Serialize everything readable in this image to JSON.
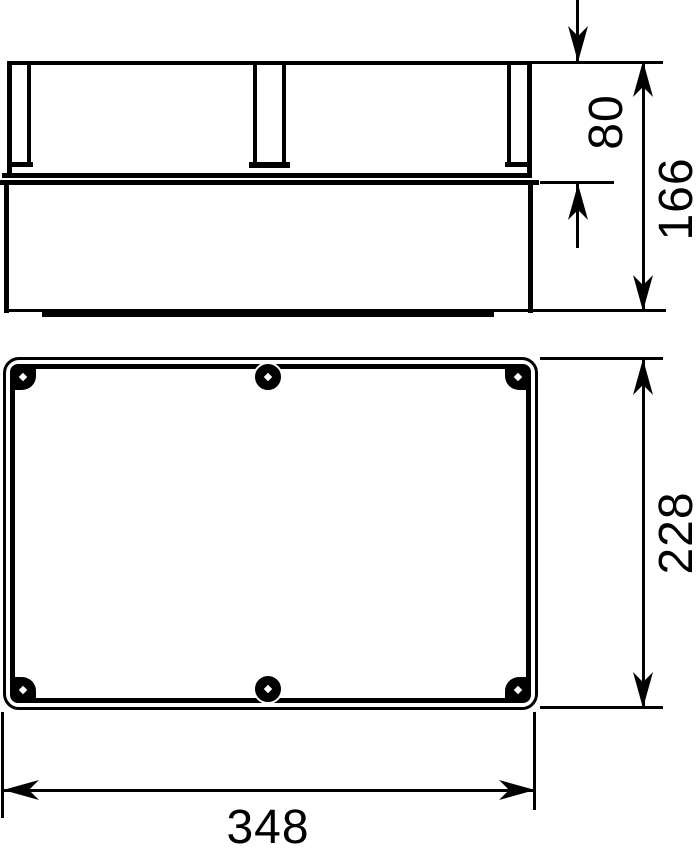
{
  "title": "Enclosure dimension drawing",
  "colors": {
    "line": "#000000",
    "background": "#ffffff"
  },
  "views": {
    "side": {
      "name": "side-elevation-with-lid"
    },
    "plan": {
      "name": "plan-view-of-base"
    }
  },
  "dimensions": {
    "lid_height": "80",
    "total_height": "166",
    "box_depth": "228",
    "box_width": "348"
  }
}
